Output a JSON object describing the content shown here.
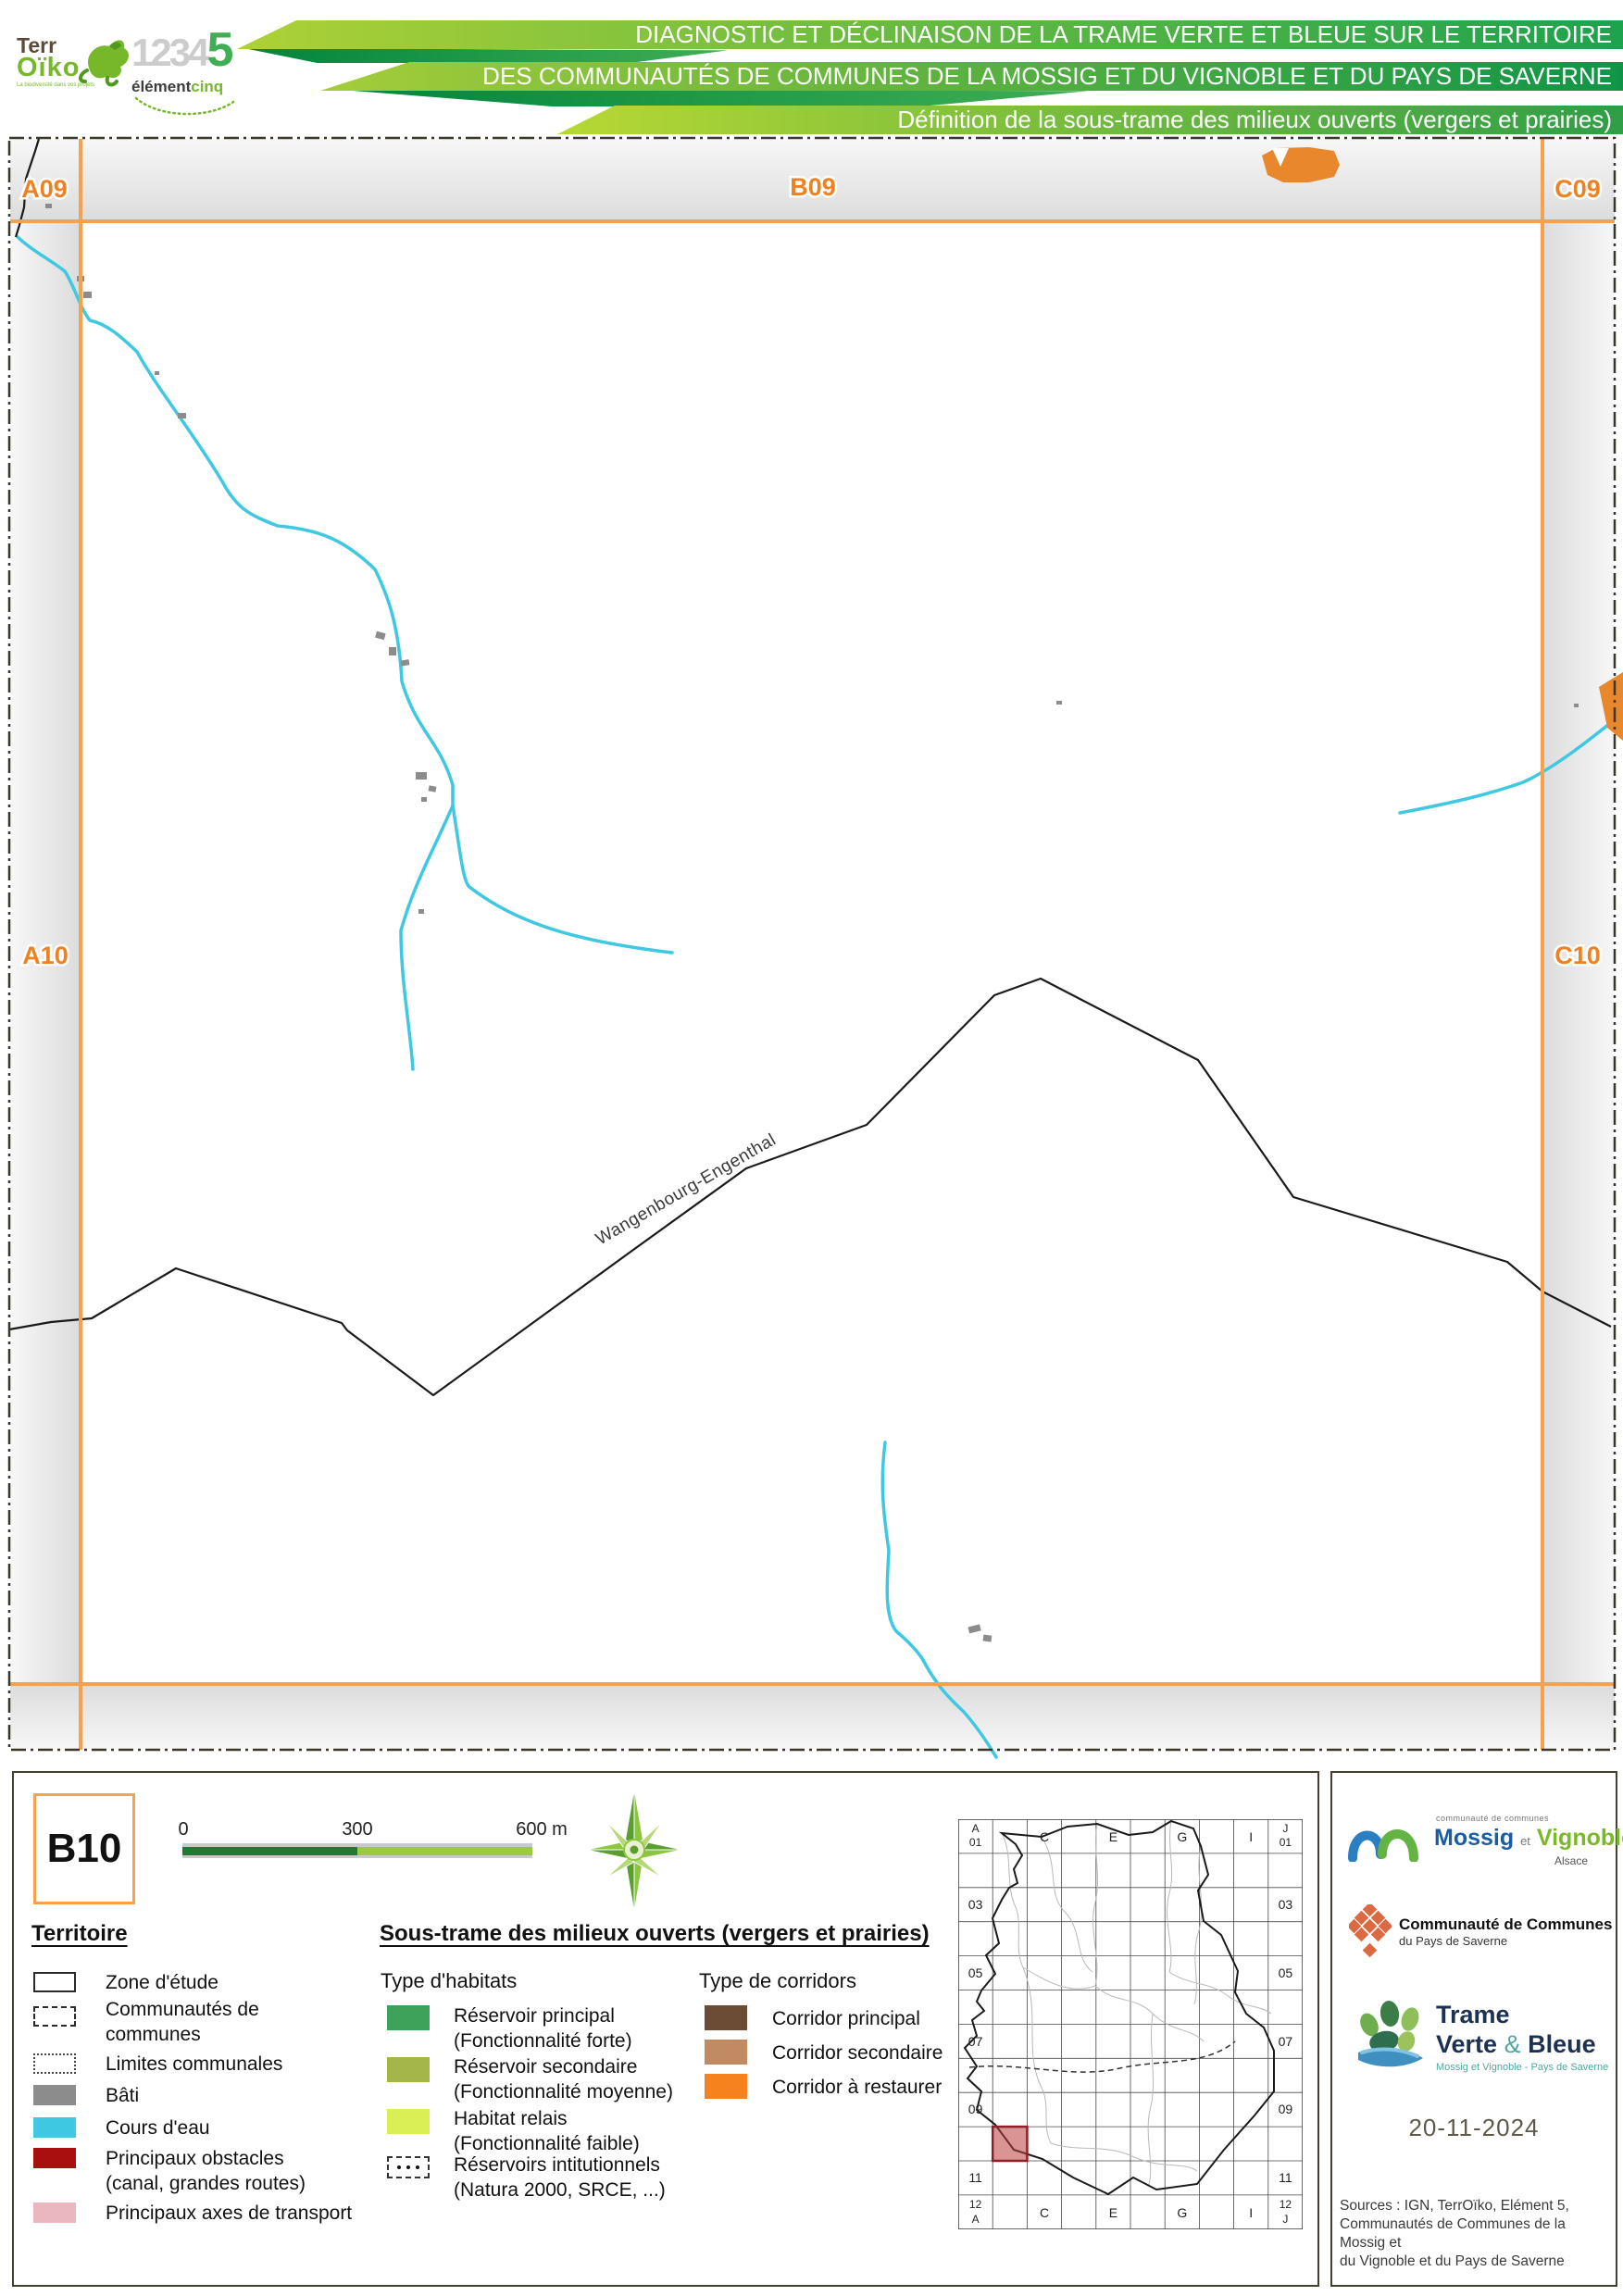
{
  "colors": {
    "frame-orange": "#F6A14C",
    "label-orange": "#EE8122",
    "water": "#3FC8E2",
    "bati": "#8C8C8C",
    "obstacle-red": "#A80F0F",
    "axes-pink": "#EBB7BE",
    "hab-principal": "#3FA25B",
    "hab-secondaire": "#A4B54A",
    "hab-relais": "#DAEE55",
    "cor-principal": "#6D4C36",
    "cor-secondaire": "#C28A62",
    "cor-restaurer": "#F5821F",
    "panel-border": "#43402F",
    "stripe-dark": "#00843D"
  },
  "header": {
    "line1": "DIAGNOSTIC ET DÉCLINAISON DE LA TRAME VERTE ET BLEUE SUR LE TERRITOIRE",
    "line2": "DES COMMUNAUTÉS DE COMMUNES DE LA MOSSIG ET DU VIGNOBLE ET DU PAYS DE SAVERNE",
    "line3": "Définition de la sous-trame des milieux ouverts (vergers et prairies)",
    "terroiko": {
      "t1": "Terr",
      "t2": "Oïko",
      "tagline": "La biodiversité dans vos projets"
    },
    "element5": {
      "digits": "1234",
      "five": "5",
      "name": "élément",
      "suffix": "cinq"
    }
  },
  "map": {
    "labels": {
      "a09": "A09",
      "b09": "B09",
      "c09": "C09",
      "a10": "A10",
      "c10": "C10"
    },
    "commune": "Wangenbourg-Engenthal"
  },
  "legend": {
    "sheet": "B10",
    "scalebar": {
      "t0": "0",
      "t300": "300",
      "t600": "600 m"
    },
    "territoire": {
      "heading": "Territoire",
      "items": [
        {
          "label": "Zone d'étude"
        },
        {
          "label": "Communautés de",
          "label2": "communes"
        },
        {
          "label": "Limites communales"
        },
        {
          "label": "Bâti"
        },
        {
          "label": "Cours d'eau"
        },
        {
          "label": "Principaux obstacles",
          "label2": "(canal, grandes routes)"
        },
        {
          "label": "Principaux axes de transport"
        }
      ]
    },
    "soustrame": {
      "heading": "Sous-trame des milieux ouverts (vergers et prairies)",
      "habitats": {
        "heading": "Type d'habitats",
        "items": [
          {
            "label": "Réservoir principal",
            "label2": "(Fonctionnalité forte)"
          },
          {
            "label": "Réservoir secondaire",
            "label2": "(Fonctionnalité moyenne)"
          },
          {
            "label": "Habitat relais",
            "label2": "(Fonctionnalité faible)"
          },
          {
            "label": "Réservoirs intitutionnels",
            "label2": "(Natura 2000, SRCE, ...)"
          }
        ]
      },
      "corridors": {
        "heading": "Type de corridors",
        "items": [
          {
            "label": "Corridor principal"
          },
          {
            "label": "Corridor secondaire"
          },
          {
            "label": "Corridor à restaurer"
          }
        ]
      }
    }
  },
  "minimap": {
    "tl_letter": "A",
    "tl_num": "01",
    "tr_letter": "J",
    "tr_num": "01",
    "cols": [
      "C",
      "E",
      "G",
      "I"
    ],
    "rows": [
      "03",
      "05",
      "07",
      "09",
      "11"
    ],
    "bl_num": "12",
    "bl_letter": "A",
    "br_num": "12",
    "br_letter": "J"
  },
  "panel": {
    "mossig": {
      "small": "communauté de communes",
      "n1": "Mossig",
      "et": "et",
      "n2": "Vignoble",
      "region": "Alsace"
    },
    "saverne": {
      "l1": "Communauté de Communes",
      "l2": "du Pays de Saverne"
    },
    "tvb": {
      "l1": "Trame",
      "l2a": "Verte",
      "amp": "&",
      "l2b": "Bleue",
      "sub": "Mossig et Vignoble - Pays de Saverne"
    },
    "date": "20-11-2024",
    "sources": "Sources : IGN, TerrOïko, Elément 5,\nCommunautés de Communes de la Mossig et\ndu Vignoble et du Pays de Saverne"
  }
}
